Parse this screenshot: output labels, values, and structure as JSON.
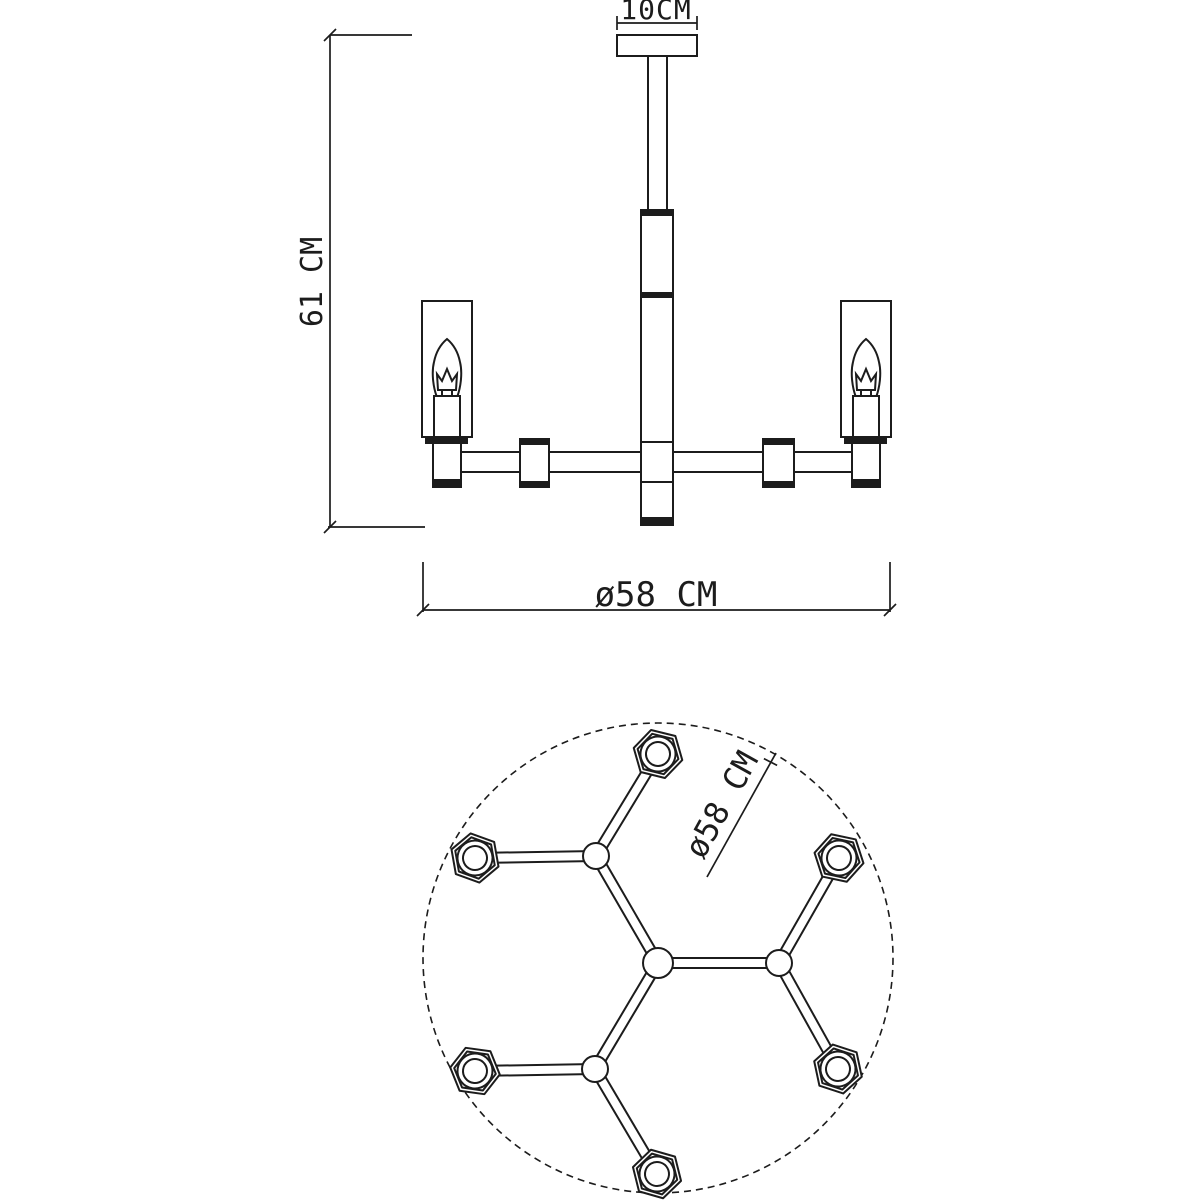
{
  "drawing": {
    "background": "#ffffff",
    "line_color": "#1c1c1c",
    "views": {
      "side_elevation": {
        "dim_canopy": "10CM",
        "dim_height": "61 CM",
        "dim_diameter": "ø58 CM"
      },
      "top_plan": {
        "dim_diameter": "ø58 CM",
        "socket_count": 6
      }
    }
  }
}
